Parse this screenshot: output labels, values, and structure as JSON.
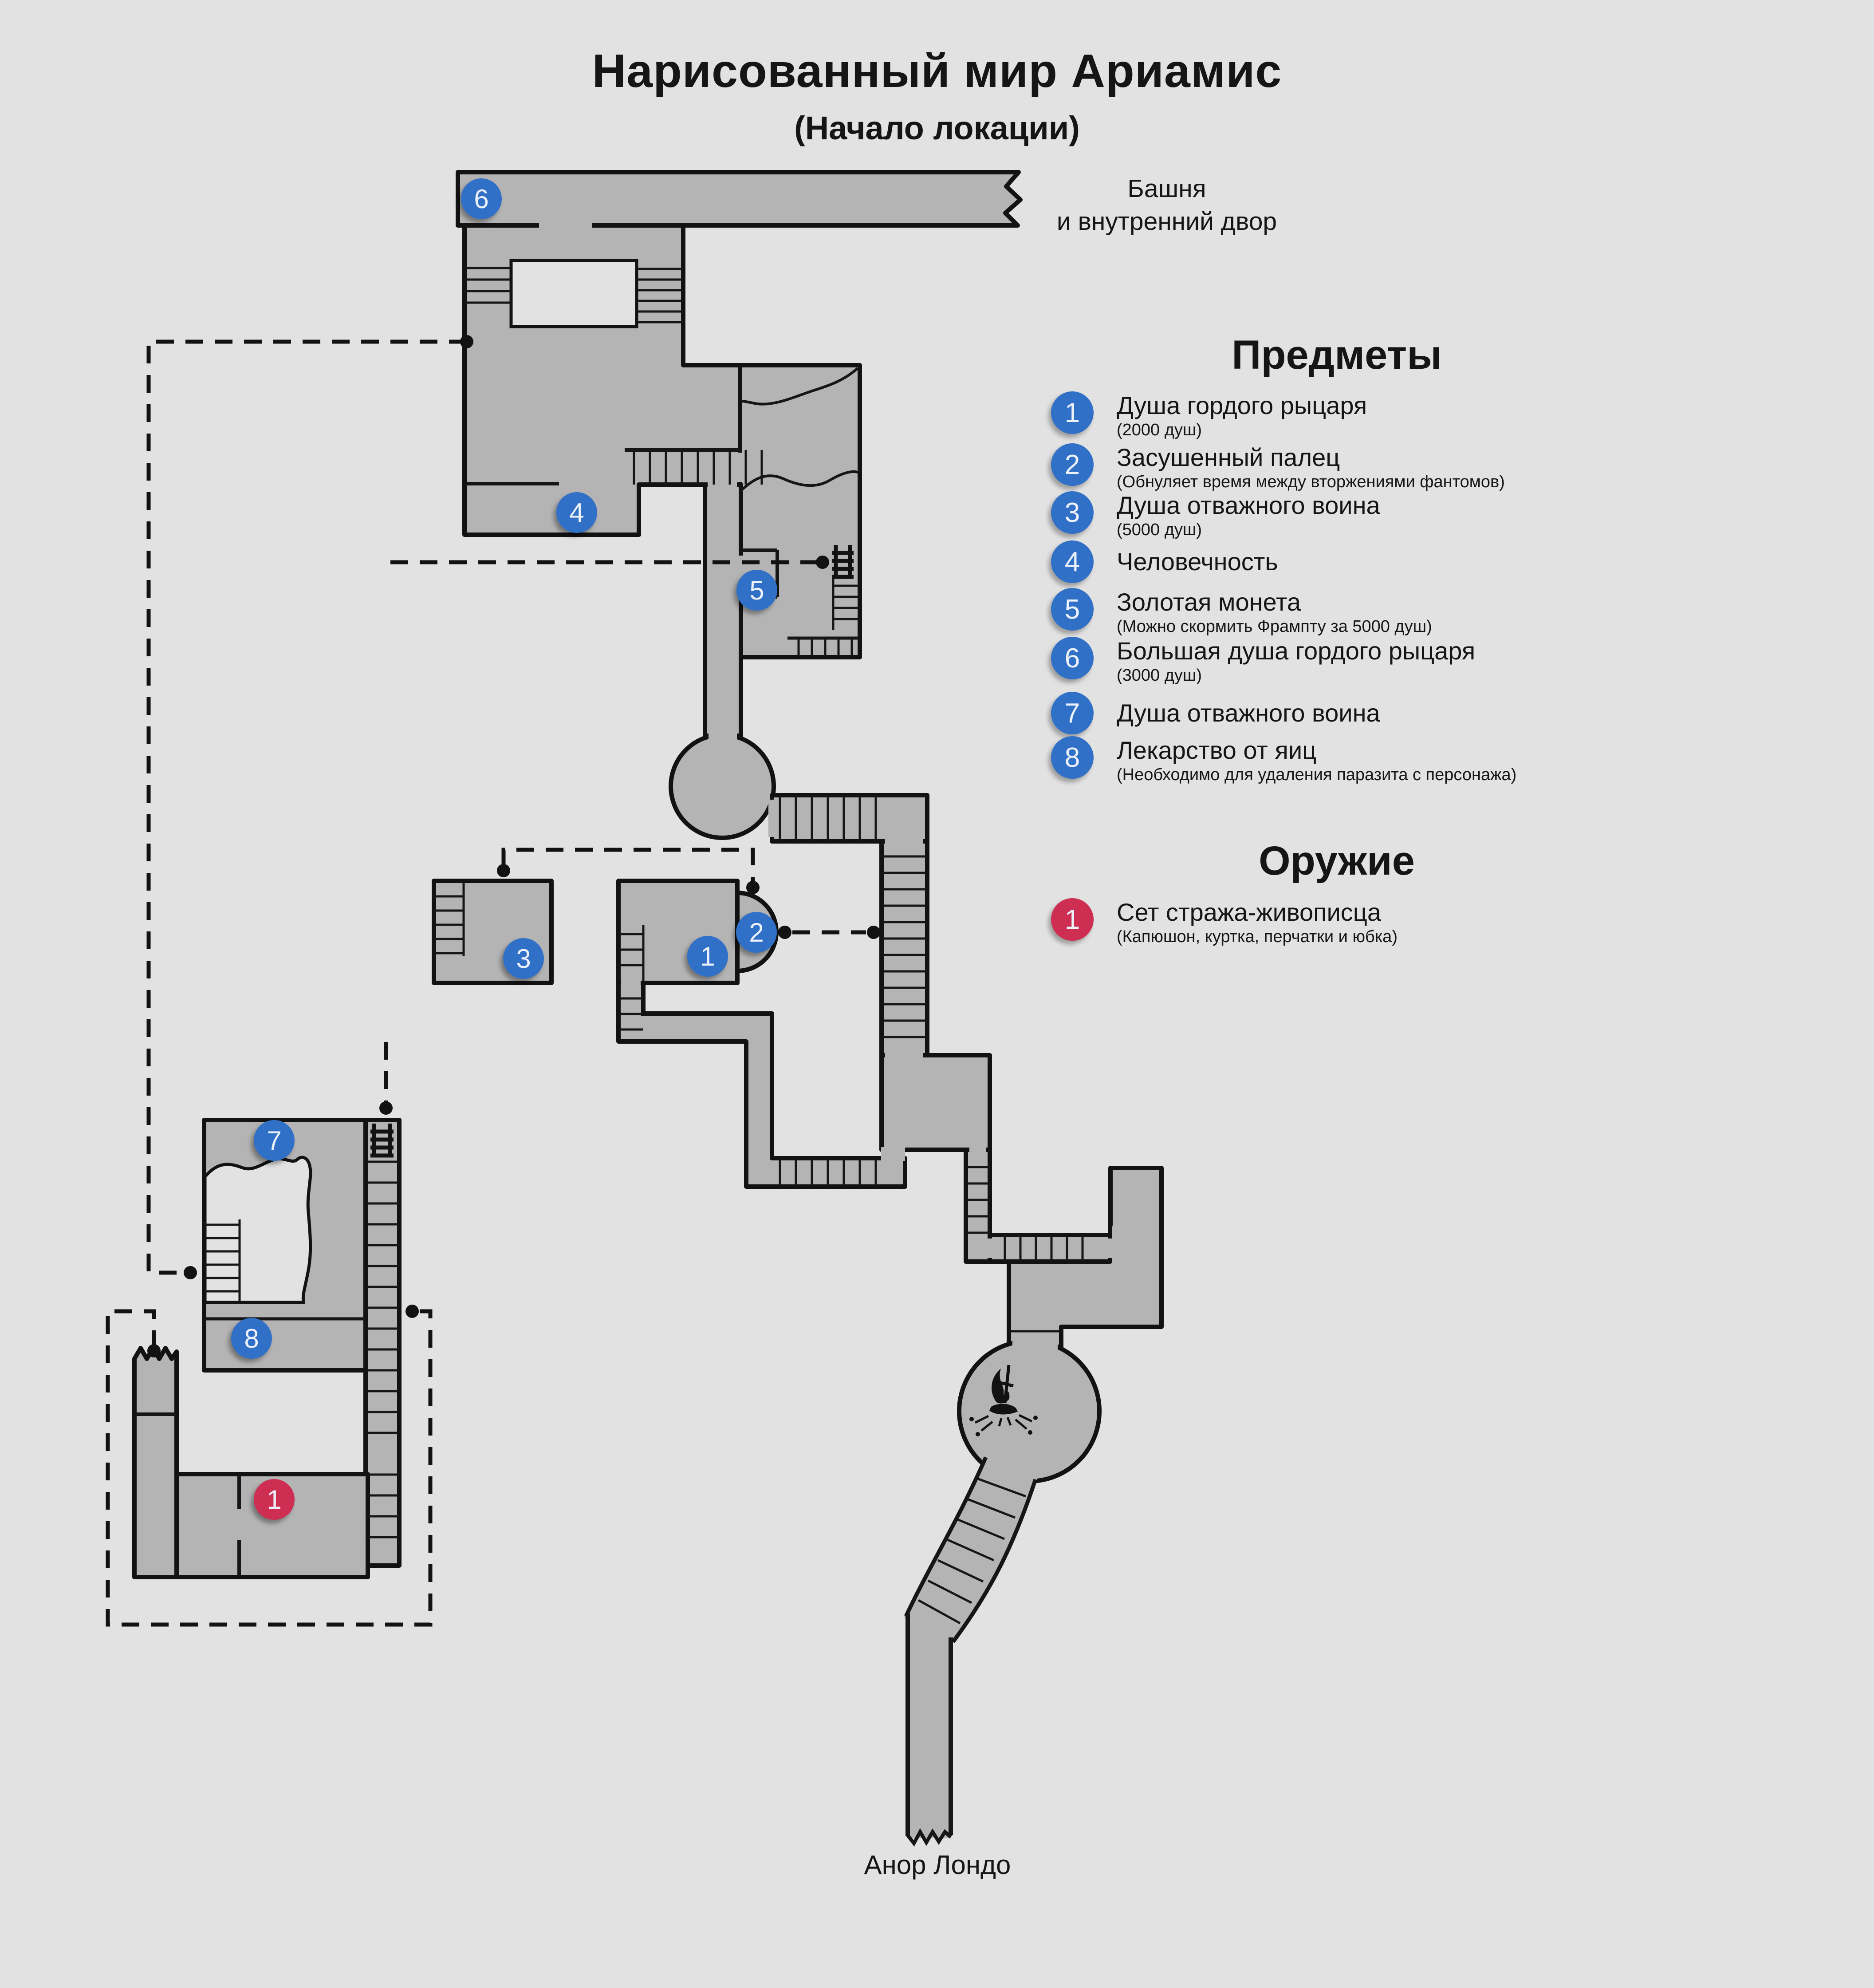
{
  "title": "Нарисованный мир Ариамис",
  "subtitle": "(Начало локации)",
  "exits": {
    "top_line1": "Башня",
    "top_line2": "и внутренний двор",
    "bottom": "Анор Лондо"
  },
  "legend": {
    "items_heading": "Предметы",
    "items": [
      {
        "num": "1",
        "label": "Душа гордого рыцаря",
        "note": "(2000 душ)"
      },
      {
        "num": "2",
        "label": "Засушенный палец",
        "note": "(Обнуляет время между вторжениями фантомов)"
      },
      {
        "num": "3",
        "label": "Душа отважного воина",
        "note": "(5000 душ)"
      },
      {
        "num": "4",
        "label": "Человечность"
      },
      {
        "num": "5",
        "label": "Золотая монета",
        "note": "(Можно скормить Фрампту за 5000 душ)"
      },
      {
        "num": "6",
        "label": "Большая душа гордого рыцаря",
        "note": "(3000 душ)"
      },
      {
        "num": "7",
        "label": "Душа отважного воина"
      },
      {
        "num": "8",
        "label": "Лекарство от яиц",
        "note": "(Необходимо для удаления паразита с персонажа)"
      }
    ],
    "weapons_heading": "Оружие",
    "weapons": [
      {
        "num": "1",
        "label": "Сет стража-живописца",
        "note": "(Капюшон, куртка, перчатки и юбка)"
      }
    ]
  },
  "map_markers": {
    "blue": [
      {
        "num": "6"
      },
      {
        "num": "4"
      },
      {
        "num": "5"
      },
      {
        "num": "3"
      },
      {
        "num": "1"
      },
      {
        "num": "2"
      },
      {
        "num": "7"
      },
      {
        "num": "8"
      }
    ],
    "red": [
      {
        "num": "1"
      }
    ]
  },
  "colors": {
    "marker_blue": "#3170c7",
    "marker_red": "#cd2e52",
    "map_fill": "#b4b4b4",
    "background": "#e2e2e2",
    "line": "#121212"
  }
}
